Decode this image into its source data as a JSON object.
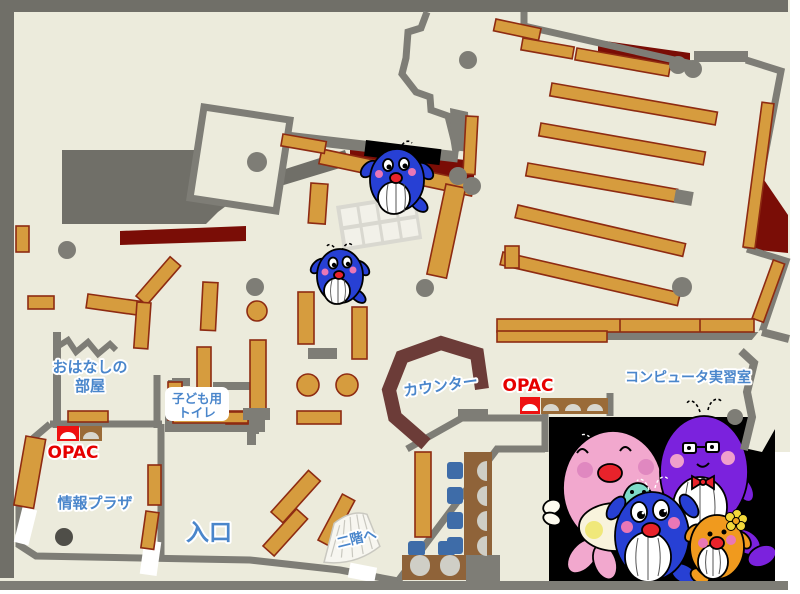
{
  "labels": {
    "story_room_line1": "おはなしの",
    "story_room_line2": "部屋",
    "kids_toilet_line1": "子ども用",
    "kids_toilet_line2": "トイレ",
    "opac_left": "OPAC",
    "opac_right": "OPAC",
    "info_plaza": "情報プラザ",
    "entrance": "入口",
    "counter": "カウンター",
    "computer_room": "コンピュータ実習室",
    "to_second_floor": "二階へ"
  },
  "mascots": {
    "panel": "whale-family-illustration",
    "members": [
      "pink-whale-mother",
      "teal-whale-baby",
      "blue-whale-child",
      "purple-whale-father",
      "orange-whale-child"
    ],
    "map_sprites": [
      "blue-whale-on-top-shelf",
      "blue-whale-center"
    ]
  },
  "colors": {
    "floor": "#ECEBDC",
    "outer_mass": "#706F68",
    "wall": "#7E7D76",
    "shelf": "#D69C3E",
    "shelf_border": "#8E2B12",
    "red_zone": "#7A0D06",
    "counter": "#6C3C38",
    "label_blue": "#4A86CB",
    "opac_red": "#E60000",
    "chair_blue": "#3E6CA8",
    "table_brown": "#8F6339",
    "panel_black": "#000000",
    "mascot_pink": "#F2A8CE",
    "mascot_blue": "#2740D4",
    "mascot_purple": "#7B22DD",
    "mascot_orange": "#F09A1E",
    "mascot_teal": "#7EDAC8"
  }
}
